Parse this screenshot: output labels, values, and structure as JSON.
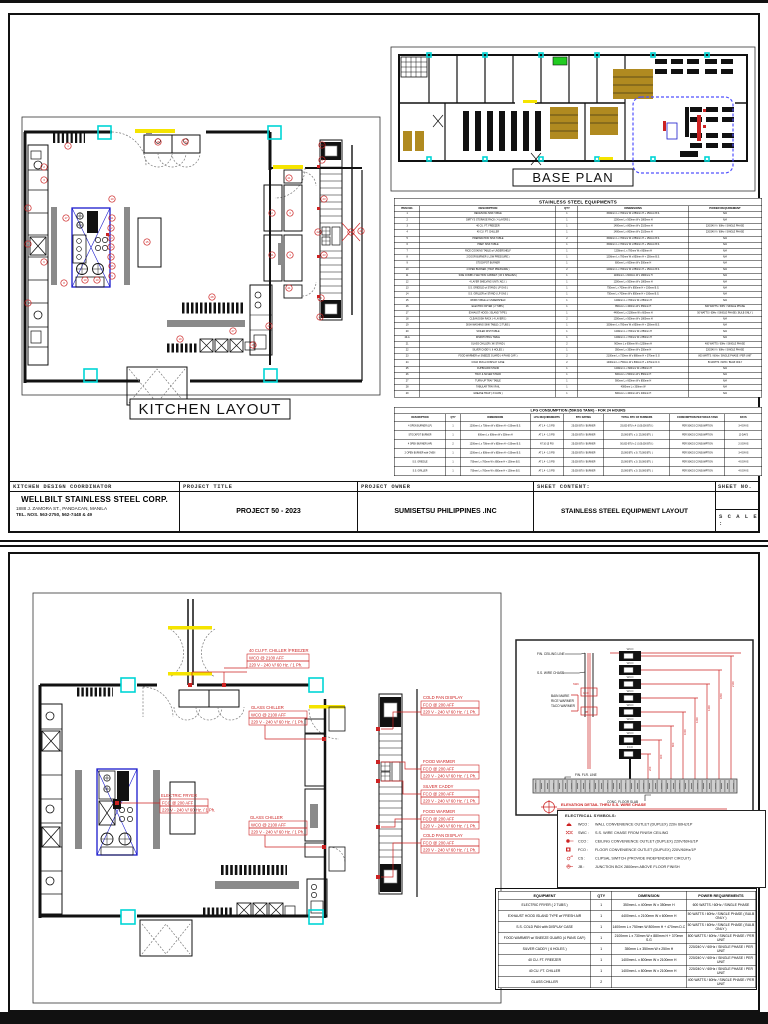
{
  "page1": {
    "kitchen_title": "KITCHEN LAYOUT",
    "baseplan_title": "BASE PLAN",
    "equipment_table": {
      "title": "STAINLESS STEEL EQUIPMENTS",
      "headers": [
        "ITEM NO.",
        "DESCRIPTION",
        "QTY",
        "DIMENSIONS",
        "POWER REQUIREMENT"
      ],
      "rows": [
        [
          "1",
          "RECEIVING SINK TABLE",
          "1",
          "1500mm L x 700mm W x 850mm H + 150mm B.S.",
          "N/A"
        ],
        [
          "2",
          "DIRTY'S STORAGE RACK ( 4 LAYERS )",
          "1",
          "1200mm L x 500mm W x 1800mm H",
          "N/A"
        ],
        [
          "3",
          "40 CU. FT. FREEZER",
          "1",
          "1400mm L x 800mm W x 2100mm H",
          "220/240 V / 60Hz / SINGLE PHASE"
        ],
        [
          "4",
          "40 CU. FT. CHILLER",
          "1",
          "1400mm L x 800mm W x 2100mm H",
          "220/240 V / 60Hz / SINGLE PHASE"
        ],
        [
          "5",
          "PREPARATION SINK TABLE",
          "2",
          "1500mm L x 700mm W x 850mm H + 150mm B.S.",
          "N/A"
        ],
        [
          "6",
          "PREP. SINK TABLE",
          "1",
          "1500mm L x 700mm W x 850mm H + 150mm B.S.",
          "N/A"
        ],
        [
          "7",
          "RICE COOKING TABLE w/ UNDERSHELF",
          "1",
          "1200mm L x 700mm W x 850mm H",
          "N/A"
        ],
        [
          "8",
          "2 DOOR BURNER ( LOW PRESSURE )",
          "1",
          "1200mm L x 700mm W x 850mm H + 150mm B.S.",
          "N/A"
        ],
        [
          "9",
          "STOCKPOT BURNER",
          "1",
          "600mm L x 600mm W x 500mm H",
          "N/A"
        ],
        [
          "10",
          "4 OPEN BURNER ( HIGH PRESSURE )",
          "2",
          "1200mm L x 700mm W x 850mm H + 150mm B.S.",
          "N/A"
        ],
        [
          "11",
          "SIDE COMBI 2 SECTION CABINET ( W/ 4 SHELVES )",
          "1",
          "1100mm L x 600mm W x 1800mm H",
          "N/A"
        ],
        [
          "12",
          "4 LAYER SHELVING UNIT ( ADJ. )",
          "1",
          "1200mm L x 500mm W x 1800mm H",
          "N/A"
        ],
        [
          "13",
          "S.S. GRIDDLE w/ STAND ( LP GAS )",
          "1",
          "750mm L x 700mm W x 850mm H + 150mm B.S.",
          "N/A"
        ],
        [
          "14",
          "S.S. GRILLER w/ STAND ( LP GAS )",
          "1",
          "750mm L x 700mm W x 850mm H + 150mm B.S.",
          "N/A"
        ],
        [
          "15",
          "WORK TABLE w/ UNDERSHELF",
          "1",
          "1200mm L x 700mm W x 850mm H",
          "N/A"
        ],
        [
          "16",
          "ELECTRIC FRYER ( 2 TUBS )",
          "1",
          "350mm L x 400mm W x 350mm H",
          "600 WATTS / 60Hz / SINGLE PHASE"
        ],
        [
          "17",
          "EXHAUST HOOD ( ISLAND TYPE )",
          "1",
          "4400mm L x 2100mm W x 600mm H",
          "50 WATTS / 60Hz / SINGLE PHASE ( BULB ONLY )"
        ],
        [
          "18",
          "CLEAN DISH RACK ( 4 LAYERS )",
          "2",
          "1200mm L x 500mm W x 1800mm H",
          "N/A"
        ],
        [
          "19",
          "DISH WASHING SINK TABLE ( 2 TUBS )",
          "1",
          "1500mm L x 700mm W x 850mm H + 150mm B.S.",
          "N/A"
        ],
        [
          "20",
          "SOILED DISH TABLE",
          "1",
          "1200mm L x 700mm W x 850mm H",
          "N/A"
        ],
        [
          "20-A",
          "DISPATCHING TABLE",
          "1",
          "1200mm L x 700mm W x 850mm H",
          "N/A"
        ],
        [
          "21",
          "GLASS CHILLER ( W/ STAND )",
          "2",
          "900mm L x 600mm W x 1200mm H",
          "400 WATTS / 60Hz / SINGLE PHASE"
        ],
        [
          "22",
          "SILVER CADDY ( 6 HOLES )",
          "1",
          "350mm L x 350mm W x 250mm H",
          "220/240 V / 60Hz / SINGLE PHASE"
        ],
        [
          "23",
          "FOOD WARMER w/ SNEEZE GUARD ( 4 PANS CAP. )",
          "2",
          "2100mm L x 730mm W x 880mm H + 370mm S.G",
          "800 WATTS / 60Hz / SINGLE PHASE / PER UNIT"
        ],
        [
          "24",
          "COLD PAN w/ DISPLAY CASE",
          "2",
          "1400mm L x 750mm W x 800mm H + 470mm D.C",
          "50 WATTS / 60Hz / BULB ONLY"
        ],
        [
          "25",
          "CUPBOARD STAND",
          "1",
          "1200mm L x 600mm W x 850mm H",
          "N/A"
        ],
        [
          "26",
          "TRAY & SILVER STAND",
          "1",
          "600mm L x 500mm W x 850mm H",
          "N/A"
        ],
        [
          "27",
          "TURN-UP TRAY TABLE",
          "1",
          "900mm L x 600mm W x 850mm H",
          "N/A"
        ],
        [
          "28",
          "TABULAR TRAY RAIL",
          "1",
          "4000mm L x 300mm W",
          "N/A"
        ],
        [
          "29",
          "GREASE TRAP ( 3 CANS )",
          "1",
          "600mm L x 400mm W x 400mm H",
          "N/A"
        ]
      ]
    },
    "lpg_table": {
      "title": "LPG CONSUMPTION (50KGS TANK) - FOR 24 HOURS",
      "headers": [
        "DESCRIPTION",
        "QTY",
        "DIMENSIONS",
        "LPG REQUIREMENTS",
        "BTU RATING",
        "TOTAL BTU OF BURNERS",
        "CONSUMPTION PER 50KGS TANK",
        "DAYS"
      ],
      "rows": [
        [
          "4 OPEN BURNER (LP)",
          "1",
          "1200mm L x 700mm W x 850mm H + 150mm B.S.",
          "AT 1.4 - 1.5 PSI",
          "25,000 BTU / BURNER",
          "25,000 BTU x 4 ( 100,000 BTU )",
          "PER 50KGS CONSUMPTION",
          "3-4 DAYS"
        ],
        [
          "STOCKPOT BURNER",
          "1",
          "600mm L x 600mm W x 500mm H",
          "AT 1.4 - 1.5 PSI",
          "25,000 BTU / BURNER",
          "25,000 BTU x 1 ( 25,000 BTU )",
          "PER 50KGS CONSUMPTION",
          "10 DAYS"
        ],
        [
          "4 OPEN BURNER (HP)",
          "2",
          "1200mm L x 700mm W x 850mm H + 150mm B.S.",
          "AT 10-15 PSI",
          "25,000 BTU / BURNER",
          "50,000 BTU x 2 ( 100,000 BTU )",
          "PER 50KGS CONSUMPTION",
          "2-3 DAYS"
        ],
        [
          "2 OPEN BURNER with OVEN",
          "1",
          "1200mm L x 800mm W x 850mm H + 150mm B.S.",
          "AT 1.4 - 1.5 PSI",
          "25,000 BTU / BURNER",
          "25,000 BTU x 3 ( 75,000 BTU )",
          "PER 50KGS CONSUMPTION",
          "3-4 DAYS"
        ],
        [
          "S.S. GRIDDLE",
          "1",
          "750mm L x 700mm W x 850mm H + 150mm B.S.",
          "AT 1.4 - 1.5 PSI",
          "25,000 BTU / BURNER",
          "25,000 BTU x 2 ( 50,000 BTU )",
          "PER 50KGS CONSUMPTION",
          "4-5 DAYS"
        ],
        [
          "S.S. GRILLER",
          "1",
          "750mm L x 700mm W x 850mm H + 150mm B.S.",
          "AT 1.4 - 1.5 PSI",
          "25,000 BTU / BURNER",
          "25,000 BTU x 2 ( 50,000 BTU )",
          "PER 50KGS CONSUMPTION",
          "4-5 DAYS"
        ]
      ]
    },
    "titleblock": {
      "coordinator_label": "KITCHEN DESIGN COORDINATOR",
      "company": "WELLBILT STAINLESS STEEL CORP.",
      "address": "1888 J. ZAMORA ST., PANDACAN, MANILA",
      "tel": "TEL. NOS. 563-2750, 562-7448 & 49",
      "project_title_label": "PROJECT TITLE",
      "project_title": "PROJECT 50 - 2023",
      "project_owner_label": "PROJECT OWNER",
      "project_owner": "SUMISETSU PHILIPPINES .INC",
      "sheet_content_label": "SHEET CONTENT:",
      "sheet_content": "STAINLESS STEEL EQUIPMENT LAYOUT",
      "sheet_no_label": "SHEET NO.",
      "scale_label": "S C A L E :"
    },
    "kitchen_callouts": [
      {
        "n": "1",
        "x": 48,
        "y": 31
      },
      {
        "n": "2",
        "x": 24,
        "y": 52
      },
      {
        "n": "3",
        "x": 24,
        "y": 65
      },
      {
        "n": "4",
        "x": 8,
        "y": 93
      },
      {
        "n": "5",
        "x": 8,
        "y": 129
      },
      {
        "n": "6",
        "x": 24,
        "y": 147
      },
      {
        "n": "7",
        "x": 8,
        "y": 188
      },
      {
        "n": "17",
        "x": 46,
        "y": 103
      },
      {
        "n": "10",
        "x": 92,
        "y": 84
      },
      {
        "n": "11",
        "x": 92,
        "y": 103
      },
      {
        "n": "12",
        "x": 91,
        "y": 113
      },
      {
        "n": "13",
        "x": 91,
        "y": 123
      },
      {
        "n": "14",
        "x": 91,
        "y": 132
      },
      {
        "n": "15",
        "x": 91,
        "y": 142
      },
      {
        "n": "16",
        "x": 92,
        "y": 151
      },
      {
        "n": "9",
        "x": 92,
        "y": 161
      },
      {
        "n": "8",
        "x": 44,
        "y": 168
      },
      {
        "n": "10",
        "x": 65,
        "y": 165
      },
      {
        "n": "10",
        "x": 77,
        "y": 165
      },
      {
        "n": "15",
        "x": 127,
        "y": 127
      },
      {
        "n": "18",
        "x": 138,
        "y": 27
      },
      {
        "n": "18",
        "x": 165,
        "y": 27
      },
      {
        "n": "21",
        "x": 269,
        "y": 63
      },
      {
        "n": "2",
        "x": 252,
        "y": 98
      },
      {
        "n": "3",
        "x": 270,
        "y": 98
      },
      {
        "n": "21",
        "x": 252,
        "y": 140
      },
      {
        "n": "4",
        "x": 270,
        "y": 140
      },
      {
        "n": "21",
        "x": 269,
        "y": 173
      },
      {
        "n": "28",
        "x": 192,
        "y": 182
      },
      {
        "n": "27",
        "x": 213,
        "y": 216
      },
      {
        "n": "19",
        "x": 160,
        "y": 224
      },
      {
        "n": "29",
        "x": 233,
        "y": 230
      },
      {
        "n": "25",
        "x": 249,
        "y": 211
      },
      {
        "n": "24",
        "x": 302,
        "y": 30
      },
      {
        "n": "3",
        "x": 302,
        "y": 45
      },
      {
        "n": "23",
        "x": 304,
        "y": 84
      },
      {
        "n": "22",
        "x": 298,
        "y": 117
      },
      {
        "n": "22",
        "x": 331,
        "y": 117
      },
      {
        "n": "26",
        "x": 341,
        "y": 116
      },
      {
        "n": "23",
        "x": 304,
        "y": 140
      },
      {
        "n": "3",
        "x": 301,
        "y": 183
      },
      {
        "n": "24",
        "x": 300,
        "y": 202
      }
    ]
  },
  "page2": {
    "annotations": [
      {
        "title": "40 CU.FT. CHILLER /FREEZER",
        "l1": "WCO @ 2100 AFF",
        "l2": "220 V - 240 V/ 60 Hz. / 1 Ph."
      },
      {
        "title": "GLASS CHILLER",
        "l1": "WCO @ 2100 AFF",
        "l2": "220 V - 240 V/ 60 Hz. / 1 Ph."
      },
      {
        "title": "ELECTRIC FRYER",
        "l1": "FCO @ 200 AFF",
        "l2": "220 V - 240 V/ 60 Hz. / 1 Ph."
      },
      {
        "title": "GLASS CHILLER",
        "l1": "WCO @ 2100 AFF",
        "l2": "220 V - 240 V/ 60 Hz. / 1 Ph."
      },
      {
        "title": "COLD PAN DISPLAY",
        "l1": "FCO @ 200 AFF",
        "l2": "220 V - 240 V/ 60 Hz. / 1 Ph."
      },
      {
        "title": "FOOD WARMER",
        "l1": "FCO @ 200 AFF",
        "l2": "220 V - 240 V/ 60 Hz. / 1 Ph."
      },
      {
        "title": "SILVER CADDY",
        "l1": "FCO @ 200 AFF",
        "l2": "220 V - 240 V/ 60 Hz. / 1 Ph."
      },
      {
        "title": "FOOD WARMER",
        "l1": "FCO @ 200 AFF",
        "l2": "220 V - 240 V/ 60 Hz. / 1 Ph."
      },
      {
        "title": "COLD PAN DISPLAY",
        "l1": "FCO @ 200 AFF",
        "l2": "220 V - 240 V/ 60 Hz. / 1 Ph."
      }
    ],
    "elevation": {
      "fin_ceiling": "FIN. CEILING LINE",
      "wire_chase": "S.S. WIRE CHASE",
      "equip1": "BAIN MARIE",
      "equip2": "RICE WARMER",
      "equip3": "TACO WARMER",
      "fin_flr": "FIN. FLR. LINE",
      "slab": "CONC. FLOOR SLAB",
      "chase_codes": [
        "SWC",
        "CCO",
        "JB"
      ],
      "outlets": [
        "WCO",
        "WCO",
        "WCO",
        "WCO",
        "WCO",
        "WCO",
        "WCO",
        "FCO"
      ],
      "dims": [
        "200",
        "400",
        "800",
        "1000",
        "1200",
        "1400",
        "1800",
        "2100"
      ],
      "title": "ELEVATION DETAIL THRU S.S. WIRE CHASE"
    },
    "legend": {
      "title": "ELECTRICAL SYMBOLS:",
      "items": [
        {
          "code": "WCO :",
          "desc": "WALL CONVENIENCE OUTLET (DUPLEX) 220v 60Hz/1P"
        },
        {
          "code": "SWC :",
          "desc": "S.S. WIRE CHASE FROM FINISH CEILING"
        },
        {
          "code": "CCO :",
          "desc": "CEILING CONVENIENCE OUTLET (DUPLEX) 220V/60Hz/1P"
        },
        {
          "code": "FCO :",
          "desc": "FLOOR CONVENIENCE OUTLET (DUPLEX) 220V/60Hz/1P"
        },
        {
          "code": "CS :",
          "desc": "CLIPSAL SWITCH (PROVIDE INDEPENDENT CIRCUIT)"
        },
        {
          "code": "JB :",
          "desc": "JUNCTION BOX 2800mm ABOVE FLOOR FINISH"
        }
      ]
    },
    "equipment_table": {
      "headers": [
        "EQUIPMENT",
        "QTY",
        "DIMENSION",
        "POWER REQUIREMENTS"
      ],
      "rows": [
        [
          "ELECTRIC FRYER ( 2 TUBS )",
          "1",
          "350mm L x 400mm W x 350mm H",
          "600 WATTS / 60Hz / SINGLE PHASE"
        ],
        [
          "EXHAUST HOOD ISLAND TYPE w/ FRESH AIR",
          "1",
          "4400mm L x 2100mm W x 600mm H",
          "50 WATTS / 60Hz / SINGLE PHASE ( BULB ONLY )"
        ],
        [
          "S.S. COLD PAN with DISPLAY CASE",
          "1",
          "1400mm L x 750mm W 800mm H + 470mm D.C",
          "50 WATTS / 60Hz / SINGLE PHASE ( BULB ONLY )"
        ],
        [
          "FOOD WARMER w/ SNEEZE GUARD (4 PANS CAP.)",
          "1",
          "2100mm L x 730mm W x 880mm H + 370mm S.G",
          "800 WATTS / 60Hz / SINGLE PHASE / PER UNIT"
        ],
        [
          "SILVER CADDY ( 6 HOLES )",
          "1",
          "350mm L x 350mm W x 250m H",
          "220/240 V / 60Hz / SINGLE PHASE / PER UNIT"
        ],
        [
          "40 CU. FT. FREEZER",
          "1",
          "1400mm L x 800mm W x 2100mm H",
          "220/240 V / 60Hz / SINGLE PHASE / PER UNIT"
        ],
        [
          "40 CU. FT. CHILLER",
          "1",
          "1400mm L x 800mm W x 2100mm H",
          "220/240 V / 60Hz / SINGLE PHASE / PER UNIT"
        ],
        [
          "GLASS CHILLER",
          "2",
          "",
          "400 WATTS / 60Hz / SINGLE PHASE / PER UNIT"
        ]
      ]
    }
  }
}
